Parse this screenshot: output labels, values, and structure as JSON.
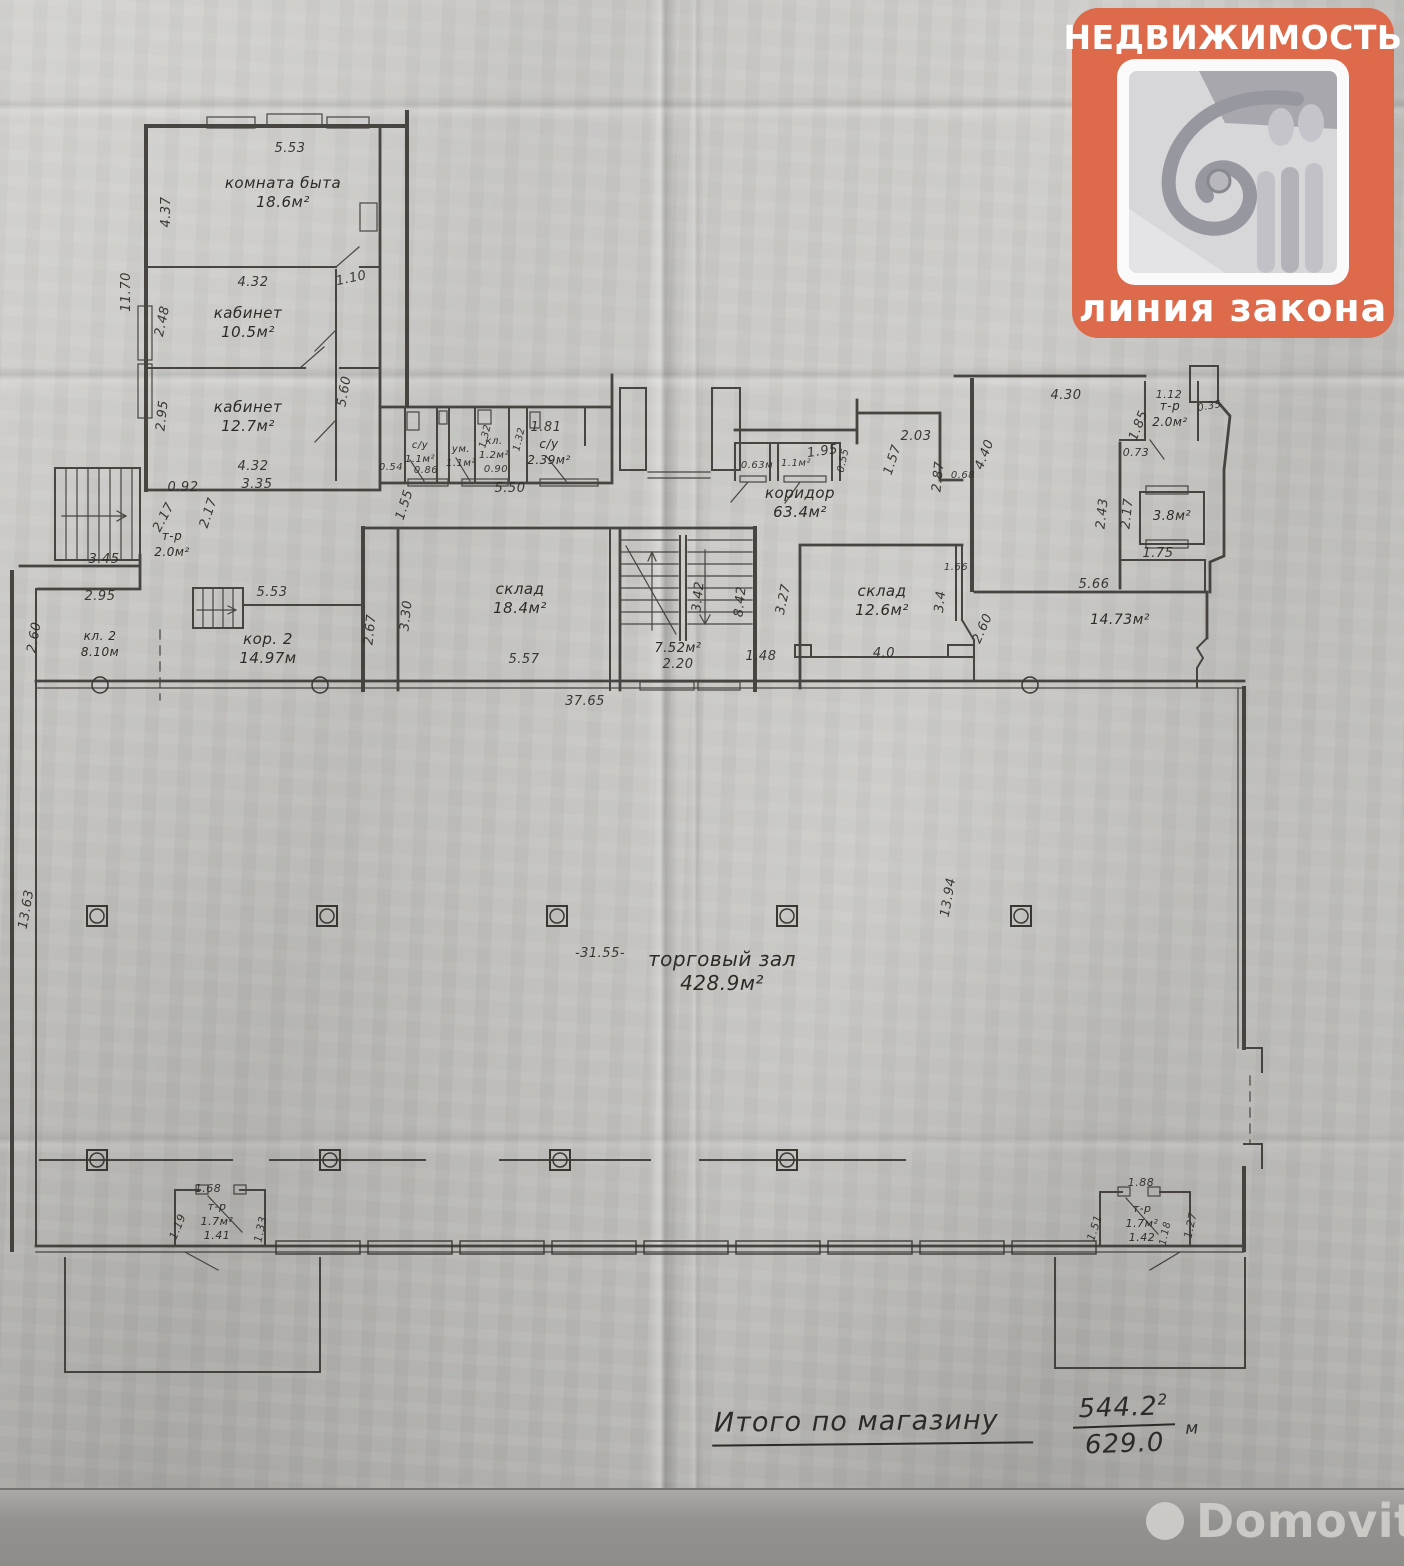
{
  "logo": {
    "top_text": "НЕДВИЖИМОСТЬ",
    "bottom_text": "линия закона",
    "accent_color": "#dd6a4b"
  },
  "watermark": {
    "text": "Domovita"
  },
  "summary": {
    "label": "Итого по магазину",
    "numerator": "544.2",
    "unit_sup": "2",
    "unit_base": "м",
    "denominator": "629.0"
  },
  "plan": {
    "rooms": [
      {
        "name": "комната быта",
        "area": "18.6м²",
        "x": 283,
        "y": 188
      },
      {
        "name": "кабинет",
        "area": "10.5м²",
        "x": 248,
        "y": 318
      },
      {
        "name": "кабинет",
        "area": "12.7м²",
        "x": 248,
        "y": 412
      },
      {
        "name": "с/у",
        "area": "1.1м²",
        "x": 420,
        "y": 448,
        "s": 10
      },
      {
        "name": "ум.",
        "area": "1.1м²",
        "x": 461,
        "y": 452,
        "s": 10
      },
      {
        "name": "кл.",
        "area": "1.2м²",
        "x": 494,
        "y": 444,
        "s": 10
      },
      {
        "name": "с/у",
        "area": "2.39м²",
        "x": 549,
        "y": 448,
        "s": 12
      },
      {
        "name": "коридор",
        "area": "63.4м²",
        "x": 800,
        "y": 498
      },
      {
        "name": "т-р",
        "area": "2.0м²",
        "x": 1170,
        "y": 410,
        "s": 12
      },
      {
        "name": "",
        "area": "3.8м²",
        "x": 1172,
        "y": 520,
        "s": 13
      },
      {
        "name": "т-р",
        "area": "2.0м²",
        "x": 172,
        "y": 540,
        "s": 12
      },
      {
        "name": "кл. 2",
        "area": "8.10м",
        "x": 100,
        "y": 640,
        "s": 12
      },
      {
        "name": "кор. 2",
        "area": "14.97м",
        "x": 268,
        "y": 644
      },
      {
        "name": "склад",
        "area": "18.4м²",
        "x": 520,
        "y": 594
      },
      {
        "name": "",
        "area": "7.52м²",
        "x": 678,
        "y": 652,
        "s": 13
      },
      {
        "name": "склад",
        "area": "12.6м²",
        "x": 882,
        "y": 596
      },
      {
        "name": "",
        "area": "14.73м²",
        "x": 1120,
        "y": 624,
        "s": 14
      },
      {
        "name": "торговый зал",
        "area": "428.9м²",
        "x": 722,
        "y": 966,
        "s": 20
      },
      {
        "name": "т-р",
        "area": "1.7м²",
        "note": "1.41",
        "x": 217,
        "y": 1210,
        "s": 11
      },
      {
        "name": "т-р",
        "area": "1.7м²",
        "note": "1.42",
        "x": 1142,
        "y": 1212,
        "s": 11
      }
    ],
    "dims": [
      {
        "t": "5.53",
        "x": 290,
        "y": 152
      },
      {
        "t": "4.37",
        "x": 170,
        "y": 212,
        "r": -90
      },
      {
        "t": "11.70",
        "x": 130,
        "y": 292,
        "r": -90
      },
      {
        "t": "4.32",
        "x": 253,
        "y": 286
      },
      {
        "t": "1.10",
        "x": 352,
        "y": 282,
        "r": -12
      },
      {
        "t": "2.48",
        "x": 166,
        "y": 322,
        "r": -78
      },
      {
        "t": "5.60",
        "x": 348,
        "y": 392,
        "r": -80
      },
      {
        "t": "2.95",
        "x": 166,
        "y": 416,
        "r": -84
      },
      {
        "t": "4.32",
        "x": 253,
        "y": 470
      },
      {
        "t": "0.92",
        "x": 183,
        "y": 491
      },
      {
        "t": "3.35",
        "x": 257,
        "y": 488
      },
      {
        "t": "2.17",
        "x": 167,
        "y": 519,
        "r": -62
      },
      {
        "t": "2.17",
        "x": 212,
        "y": 514,
        "r": -72
      },
      {
        "t": "3.45",
        "x": 104,
        "y": 563
      },
      {
        "t": "0.54",
        "x": 391,
        "y": 470,
        "s": 10
      },
      {
        "t": "0.86",
        "x": 426,
        "y": 473,
        "s": 10
      },
      {
        "t": "1.55",
        "x": 408,
        "y": 506,
        "r": -72
      },
      {
        "t": "1.32",
        "x": 488,
        "y": 437,
        "r": -76,
        "s": 10
      },
      {
        "t": "0.90",
        "x": 496,
        "y": 472,
        "s": 10
      },
      {
        "t": "1.32",
        "x": 522,
        "y": 440,
        "r": -76,
        "s": 10
      },
      {
        "t": "1.81",
        "x": 546,
        "y": 431
      },
      {
        "t": "5.50",
        "x": 510,
        "y": 492
      },
      {
        "t": "0.63м",
        "x": 757,
        "y": 468,
        "s": 10
      },
      {
        "t": "1.1м²",
        "x": 796,
        "y": 466,
        "s": 10
      },
      {
        "t": "1.95",
        "x": 823,
        "y": 455,
        "r": -8
      },
      {
        "t": "0.55",
        "x": 846,
        "y": 461,
        "r": -78,
        "s": 10
      },
      {
        "t": "1.57",
        "x": 896,
        "y": 461,
        "r": -72
      },
      {
        "t": "2.03",
        "x": 916,
        "y": 440
      },
      {
        "t": "2.87",
        "x": 942,
        "y": 477,
        "r": -84
      },
      {
        "t": "0.68",
        "x": 963,
        "y": 478,
        "s": 10
      },
      {
        "t": "4.40",
        "x": 988,
        "y": 456,
        "r": -68
      },
      {
        "t": "4.30",
        "x": 1066,
        "y": 399
      },
      {
        "t": "1.12",
        "x": 1169,
        "y": 398,
        "s": 11
      },
      {
        "t": "0.35",
        "x": 1210,
        "y": 409,
        "r": -10,
        "s": 10
      },
      {
        "t": "1.85",
        "x": 1142,
        "y": 427,
        "r": -68
      },
      {
        "t": "0.73",
        "x": 1136,
        "y": 456,
        "s": 11
      },
      {
        "t": "2.43",
        "x": 1106,
        "y": 514,
        "r": -84
      },
      {
        "t": "2.17",
        "x": 1131,
        "y": 514,
        "r": -84
      },
      {
        "t": "1.75",
        "x": 1158,
        "y": 557
      },
      {
        "t": "2.95",
        "x": 100,
        "y": 600
      },
      {
        "t": "5.53",
        "x": 272,
        "y": 596
      },
      {
        "t": "2.60",
        "x": 38,
        "y": 638,
        "r": -80
      },
      {
        "t": "2.67",
        "x": 374,
        "y": 630,
        "r": -84
      },
      {
        "t": "3.30",
        "x": 410,
        "y": 616,
        "r": -84
      },
      {
        "t": "5.57",
        "x": 524,
        "y": 663
      },
      {
        "t": "3.42",
        "x": 702,
        "y": 597,
        "r": -84
      },
      {
        "t": "8.42",
        "x": 744,
        "y": 602,
        "r": -84
      },
      {
        "t": "2.20",
        "x": 678,
        "y": 668
      },
      {
        "t": "1.48",
        "x": 761,
        "y": 660
      },
      {
        "t": "3.27",
        "x": 787,
        "y": 600,
        "r": -78
      },
      {
        "t": "4.0",
        "x": 884,
        "y": 657
      },
      {
        "t": "3.4",
        "x": 944,
        "y": 602,
        "r": -84
      },
      {
        "t": "1.66",
        "x": 956,
        "y": 570,
        "s": 10
      },
      {
        "t": "2.60",
        "x": 986,
        "y": 630,
        "r": -66
      },
      {
        "t": "5.66",
        "x": 1094,
        "y": 588
      },
      {
        "t": "37.65",
        "x": 585,
        "y": 705
      },
      {
        "t": "-31.55-",
        "x": 600,
        "y": 957
      },
      {
        "t": "13.63",
        "x": 30,
        "y": 910,
        "r": -80
      },
      {
        "t": "13.94",
        "x": 952,
        "y": 898,
        "r": -80
      },
      {
        "t": "1.68",
        "x": 208,
        "y": 1192,
        "s": 11
      },
      {
        "t": "1.19",
        "x": 181,
        "y": 1228,
        "r": -68,
        "s": 11
      },
      {
        "t": "1.33",
        "x": 264,
        "y": 1230,
        "r": -78,
        "s": 11
      },
      {
        "t": "1.88",
        "x": 1141,
        "y": 1186,
        "s": 11
      },
      {
        "t": "1.51",
        "x": 1098,
        "y": 1229,
        "r": -72,
        "s": 11
      },
      {
        "t": "1.18",
        "x": 1168,
        "y": 1234,
        "r": -78,
        "s": 10
      },
      {
        "t": "1.27",
        "x": 1194,
        "y": 1226,
        "r": -78,
        "s": 11
      }
    ],
    "columns": [
      {
        "y": 916,
        "xs": [
          97,
          327,
          557,
          787,
          1021
        ]
      },
      {
        "y": 1160,
        "xs": [
          97,
          330,
          560,
          787
        ]
      }
    ],
    "wall_columns": [
      {
        "x": 100,
        "y": 685
      },
      {
        "x": 320,
        "y": 685
      },
      {
        "x": 1030,
        "y": 685
      }
    ]
  }
}
